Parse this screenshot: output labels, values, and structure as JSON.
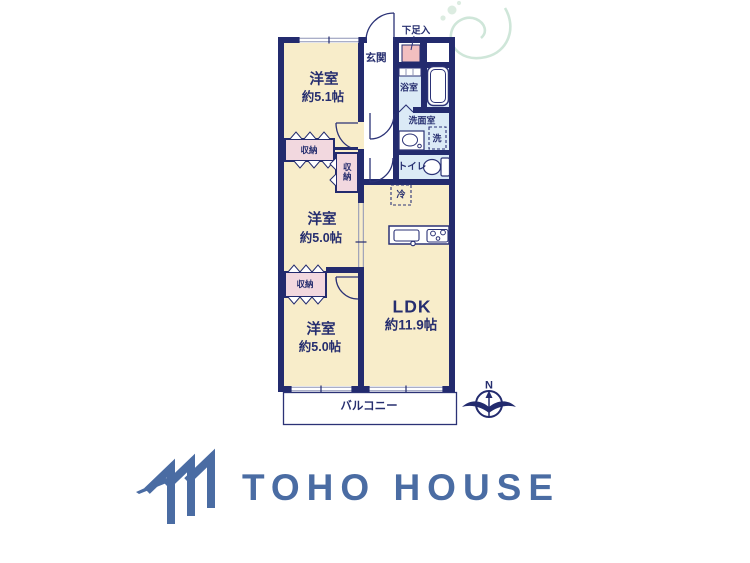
{
  "floorplan": {
    "rooms": {
      "room1": {
        "label": "洋室",
        "size": "約5.1帖"
      },
      "room2": {
        "label": "洋室",
        "size": "約5.0帖"
      },
      "room3": {
        "label": "洋室",
        "size": "約5.0帖"
      },
      "ldk": {
        "label": "LDK",
        "size": "約11.9帖"
      }
    },
    "labels": {
      "entrance": "玄関",
      "shoe_cabinet": "下足入",
      "bathroom": "浴室",
      "washroom": "洗面室",
      "washer": "洗",
      "toilet": "トイレ",
      "refrigerator": "冷",
      "closet": "収納",
      "balcony": "バルコニー"
    },
    "compass": {
      "north": "N"
    },
    "colors": {
      "wall": "#232b6e",
      "room_fill": "#f8edca",
      "closet_fill": "#f2d8df",
      "shoe_cabinet_fill": "#f2bfc0",
      "wet_area_fill": "#dbeaf6",
      "fixture_line": "#2b3276",
      "window_line": "#8d93b5",
      "flourish": "#cfe6d9"
    }
  },
  "logo": {
    "text": "TOHO HOUSE",
    "color": "#4a6ca3"
  }
}
